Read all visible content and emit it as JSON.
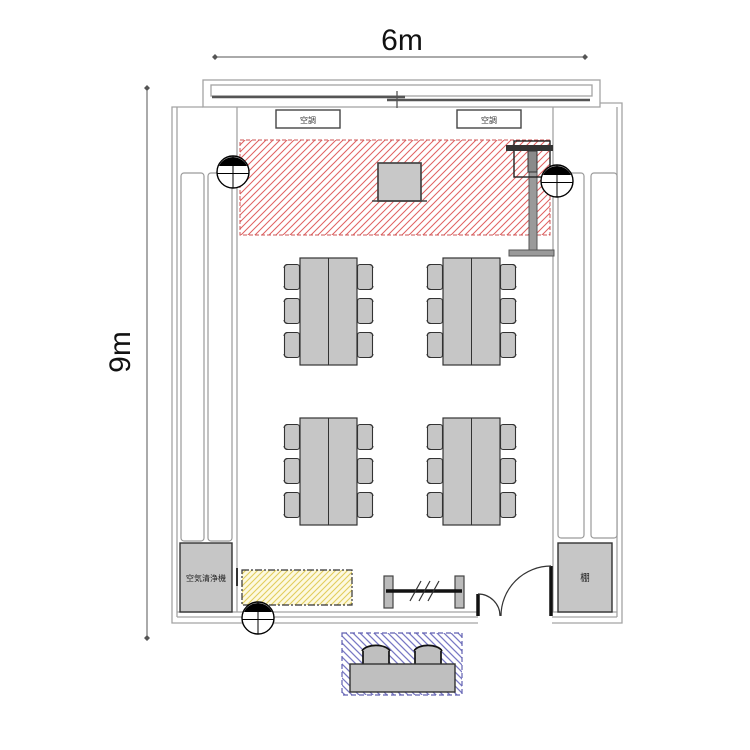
{
  "plan": {
    "dimension_width": "6m",
    "dimension_height": "9m"
  },
  "labels": {
    "hvac": [
      "空調",
      "空調"
    ],
    "air_purifier": "空気清浄機",
    "shelf": "棚"
  },
  "colors": {
    "stage_hatch": "#e06060",
    "stage_border": "#cc5555",
    "storage_hatch": "#e2cd5c",
    "storage_bg": "#fdf9e0",
    "reception_hatch": "#7878c4",
    "reception_border": "#6060b0",
    "furniture_fill": "#c6c6c6",
    "wall_stroke": "#a3a3a3"
  },
  "furniture": {
    "table_groups": 4,
    "chairs_per_group": 6,
    "total_chairs": 24,
    "reception_stools": 2,
    "ceiling_speakers": 3,
    "hvac_units": 2,
    "screens": 1,
    "whiteboards": 1
  }
}
